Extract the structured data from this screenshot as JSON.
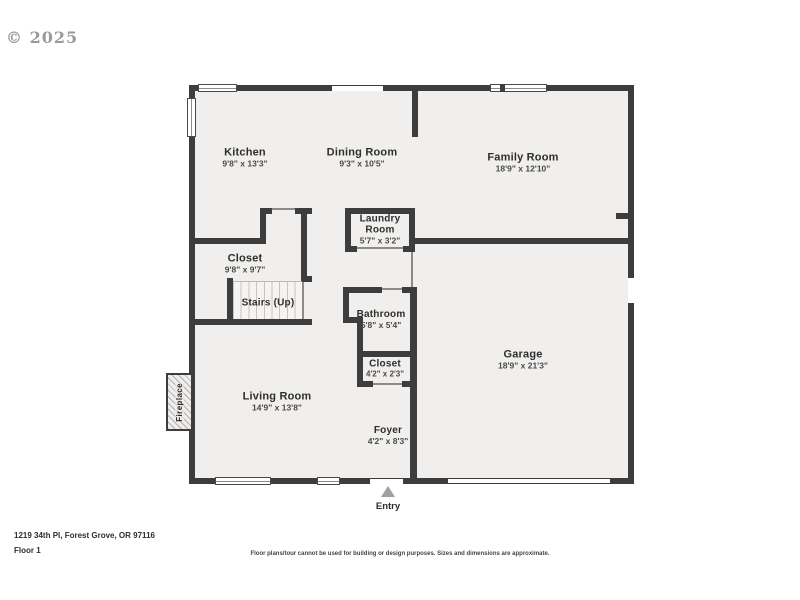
{
  "watermark": {
    "text": "© 2025"
  },
  "floorplan": {
    "rooms": [
      {
        "name": "Kitchen",
        "dims": "9'8\" x 13'3\""
      },
      {
        "name": "Dining Room",
        "dims": "9'3\" x 10'5\""
      },
      {
        "name": "Family Room",
        "dims": "18'9\" x 12'10\""
      },
      {
        "name": "Laundry Room",
        "dims": "5'7\" x 3'2\""
      },
      {
        "name": "Closet",
        "dims": "9'8\" x 9'7\""
      },
      {
        "name": "Stairs (Up)",
        "dims": ""
      },
      {
        "name": "Bathroom",
        "dims": "5'8\" x 5'4\""
      },
      {
        "name": "Closet",
        "dims": "4'2\" x 2'3\""
      },
      {
        "name": "Garage",
        "dims": "18'9\" x 21'3\""
      },
      {
        "name": "Living Room",
        "dims": "14'9\" x 13'8\""
      },
      {
        "name": "Foyer",
        "dims": "4'2\" x 8'3\""
      }
    ],
    "fireplace_label": "Fireplace",
    "entry_label": "Entry"
  },
  "footer": {
    "address": "1219 34th Pl, Forest Grove, OR 97116",
    "floor": "Floor 1",
    "disclaimer": "Floor plans/tour cannot be used for building or design purposes. Sizes and dimensions are approximate."
  },
  "colors": {
    "wall": "#3d3d3d",
    "floor": "#f0efed",
    "watermark": "#9a9a9a",
    "entry_arrow": "#a0a0a0"
  }
}
